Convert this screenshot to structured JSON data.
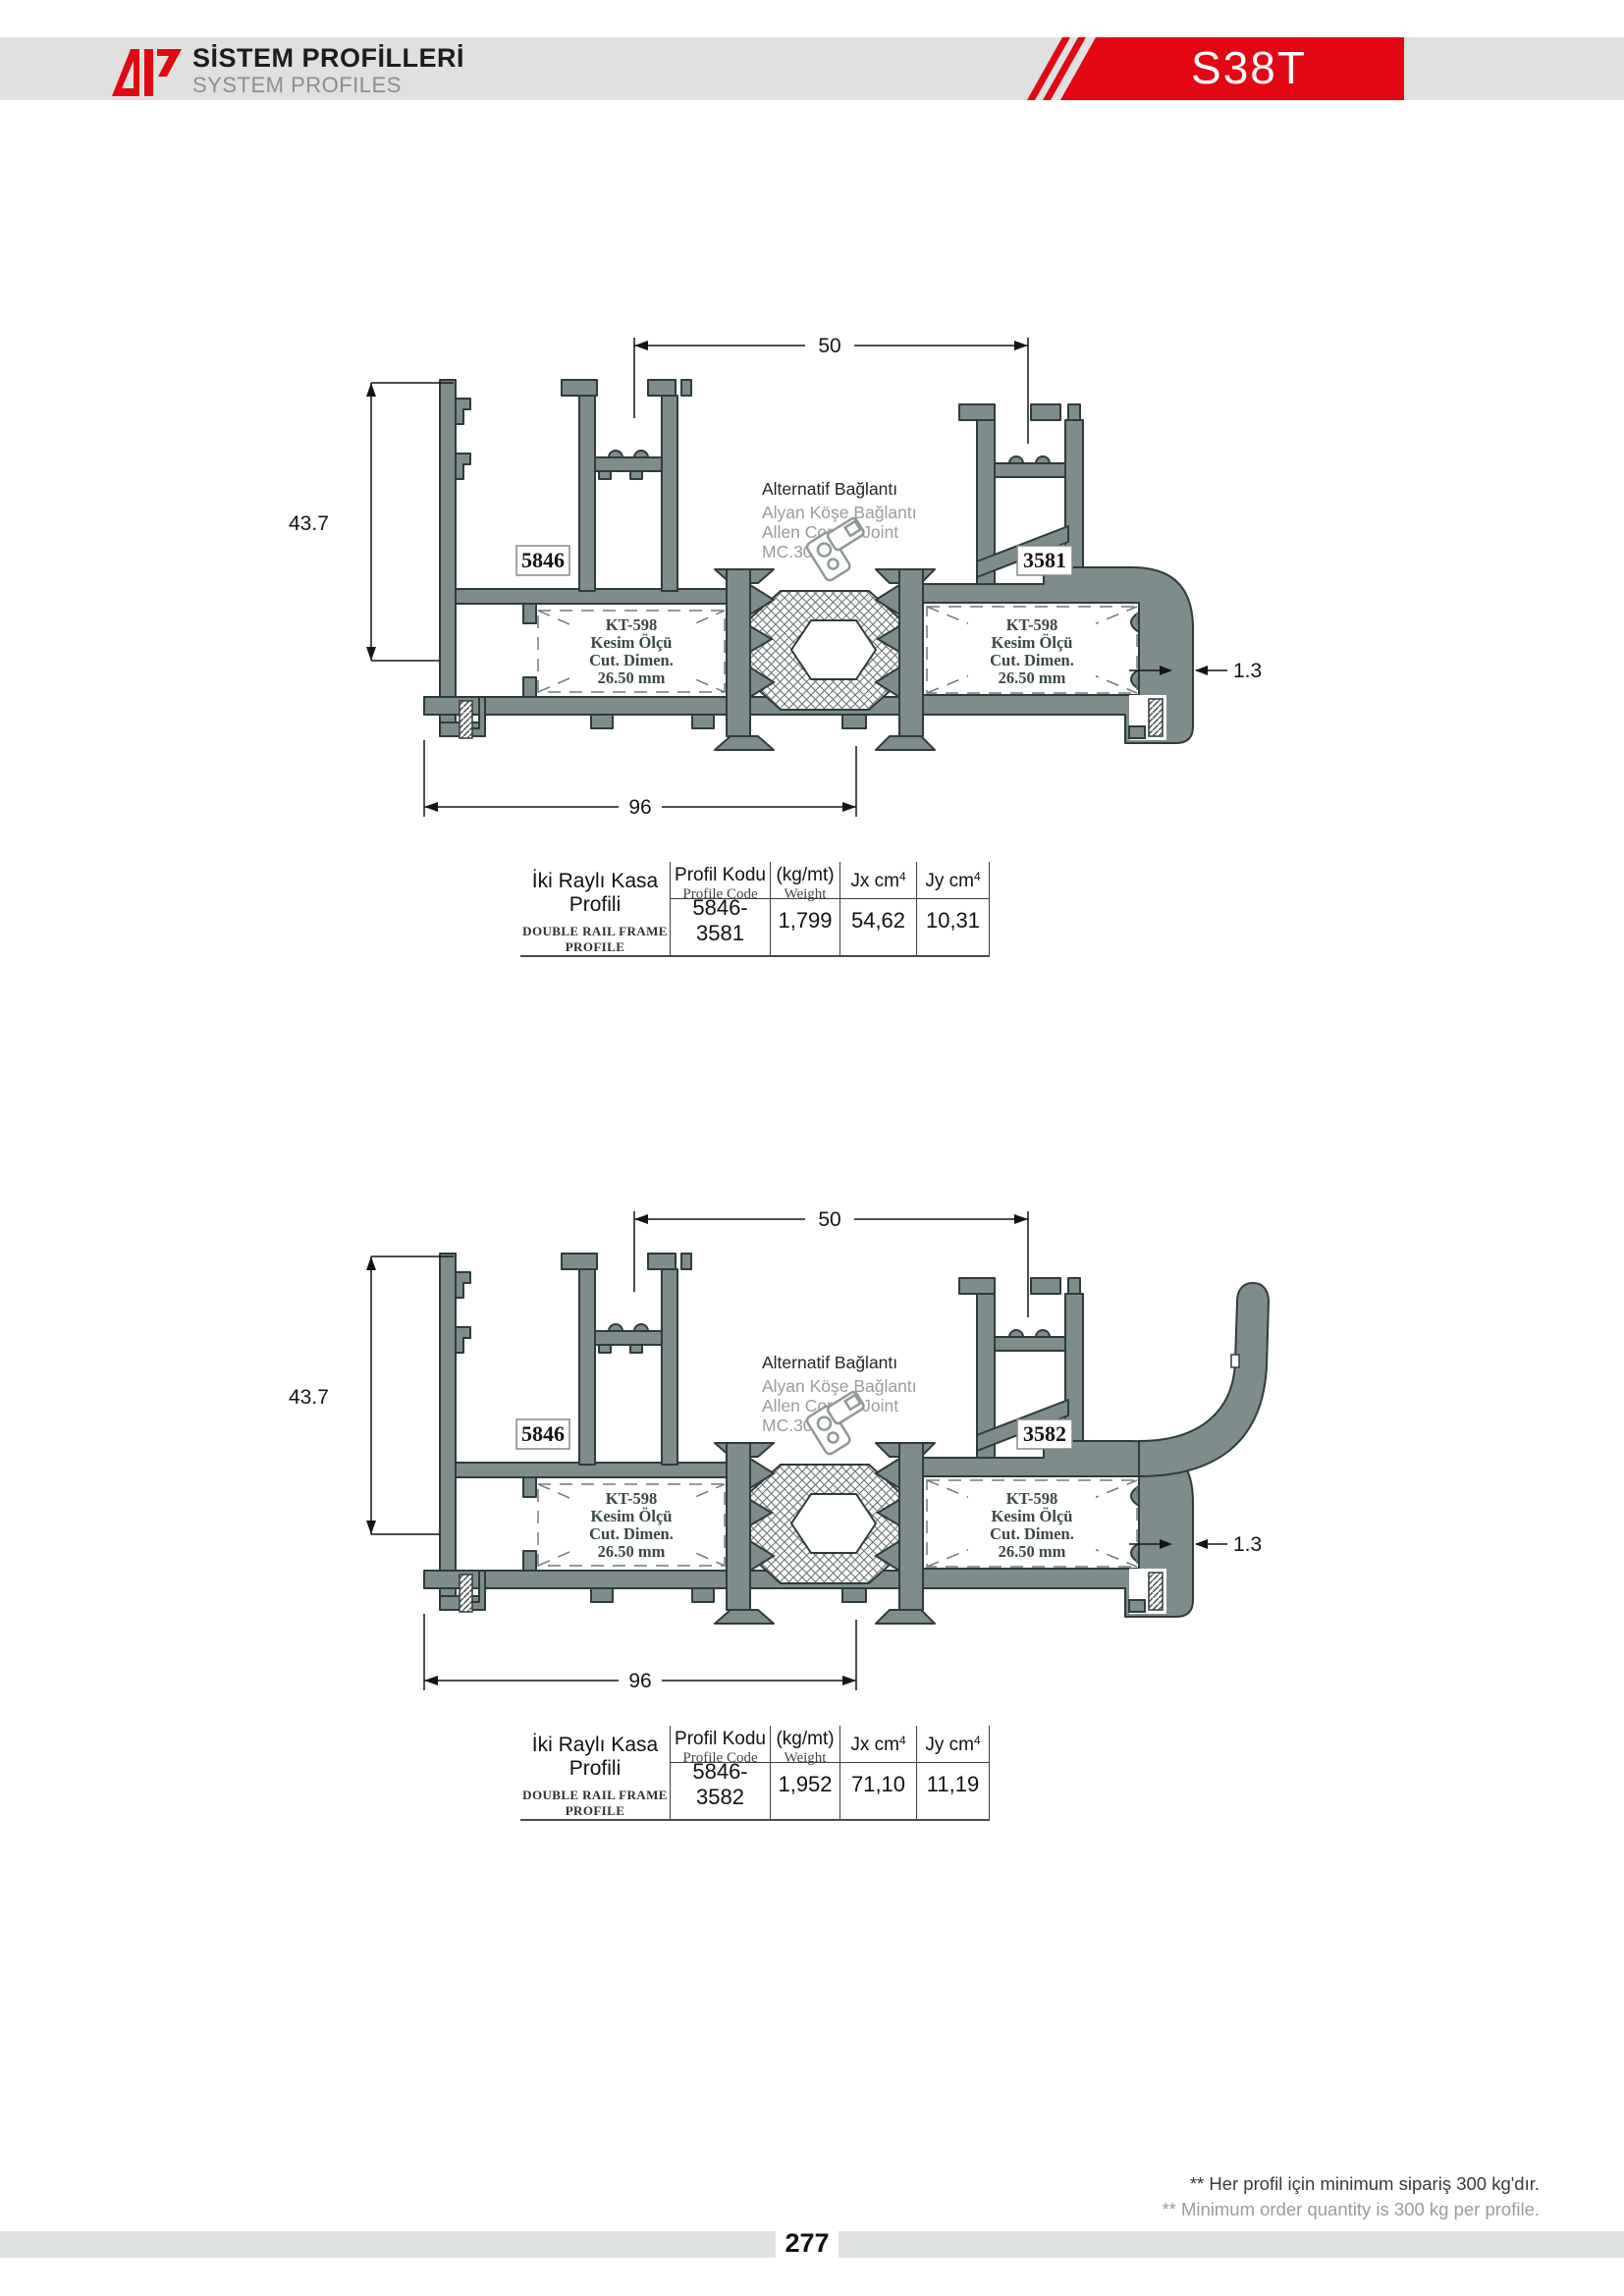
{
  "header": {
    "title_tr": "SİSTEM PROFİLLERİ",
    "title_en": "SYSTEM PROFILES",
    "model": "S38T"
  },
  "drawings": [
    {
      "dim_width": "50",
      "dim_height": "43.7",
      "dim_total": "96",
      "dim_wall": "1.3",
      "left_profile_code": "5846",
      "right_profile_code": "3581",
      "cut_note": {
        "l1": "KT-598",
        "l2": "Kesim Ölçü",
        "l3": "Cut. Dimen.",
        "l4": "26.50 mm"
      },
      "joint_note": {
        "l1": "Alternatif Bağlantı",
        "l2": "Alyan Köşe Bağlantı",
        "l3": "Allen Corner Joint",
        "l4": "MC.307"
      }
    },
    {
      "dim_width": "50",
      "dim_height": "43.7",
      "dim_total": "96",
      "dim_wall": "1.3",
      "left_profile_code": "5846",
      "right_profile_code": "3582",
      "cut_note": {
        "l1": "KT-598",
        "l2": "Kesim Ölçü",
        "l3": "Cut. Dimen.",
        "l4": "26.50 mm"
      },
      "joint_note": {
        "l1": "Alternatif Bağlantı",
        "l2": "Alyan Köşe Bağlantı",
        "l3": "Allen Corner Joint",
        "l4": "MC.307"
      }
    }
  ],
  "tables": [
    {
      "name_tr": "İki Raylı Kasa Profili",
      "name_en": "DOUBLE RAIL FRAME  PROFILE",
      "col1_l1": "Profil Kodu",
      "col1_l2": "Profile Code",
      "col2_l1": "(kg/mt)",
      "col2_l2": "Weight",
      "col3": "Jx cm",
      "col4": "Jy cm",
      "sup": "4",
      "row": {
        "code": "5846-3581",
        "weight": "1,799",
        "jx": "54,62",
        "jy": "10,31"
      }
    },
    {
      "name_tr": "İki Raylı Kasa Profili",
      "name_en": "DOUBLE RAIL FRAME  PROFILE",
      "col1_l1": "Profil Kodu",
      "col1_l2": "Profile Code",
      "col2_l1": "(kg/mt)",
      "col2_l2": "Weight",
      "col3": "Jx cm",
      "col4": "Jy cm",
      "sup": "4",
      "row": {
        "code": "5846-3582",
        "weight": "1,952",
        "jx": "71,10",
        "jy": "11,19"
      }
    }
  ],
  "footer": {
    "note_tr": "** Her profil için minimum sipariş 300 kg'dır.",
    "note_en": "** Minimum order quantity is 300 kg per profile.",
    "page": "277"
  },
  "colors": {
    "accent_red": "#E30613",
    "profile_fill": "#7E8C8C",
    "band_gray": "#DEE1DE"
  }
}
